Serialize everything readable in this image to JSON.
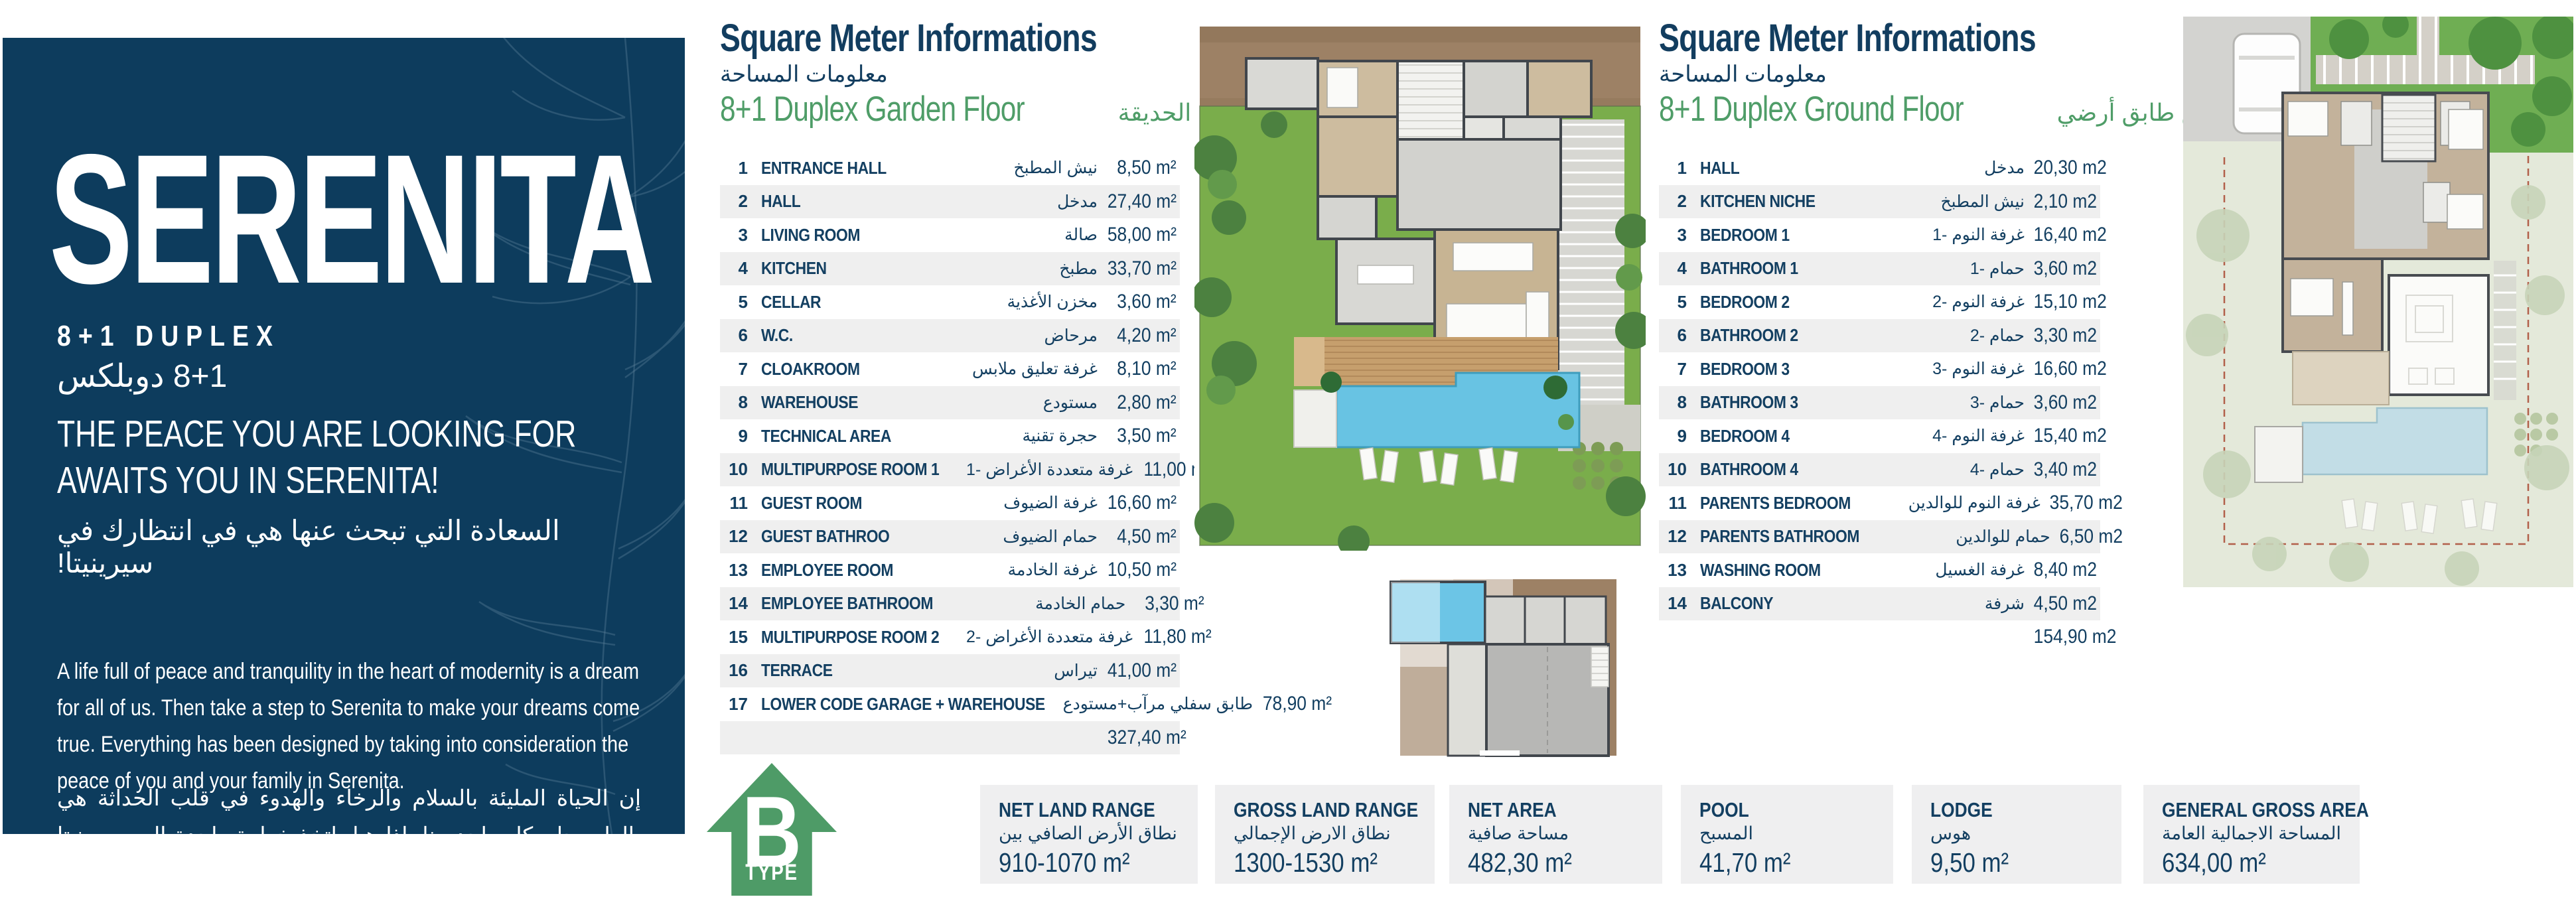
{
  "colors": {
    "panel_navy": "#0d3c5d",
    "text_navy": "#133f61",
    "accent_green": "#4e9b67",
    "row_stripe": "#efefef",
    "box_gray": "#efeff0",
    "lawn_green": "#7aad4b",
    "pool_blue": "#68c3e3",
    "ground_brown": "#9d8165",
    "pale_sage": "#e4e9da"
  },
  "left_panel": {
    "title": "SERENITA",
    "subtitle": "8+1 DUPLEX",
    "subtitle_ar": "8+1 دوبلكس",
    "headline1": "THE PEACE YOU ARE LOOKING FOR",
    "headline2": "AWAITS YOU IN SERENITA!",
    "headline_ar": "السعادة التي تبحث عنها هي في انتظارك في سيرينيتا!",
    "body": "A life full of peace and tranquility in the heart of modernity is a dream for all of us. Then take a step to Serenita to make your dreams come true. Everything has been designed by taking into consideration the peace of you and your family in Serenita.",
    "body_ar": "إن الحياة المليئة بالسلام والرخاء والهدوء في قلب الحداثة هي بالطبع حلم كل واحد منا. إذا هيا، اتخذ خطوة واحدة إلى سيرينيتا لتحقيق أحلامك حتى لا تفوت فرص الحياة. لقد تم تصميم كل شيء هنا لراحة البال لك وسلامة عائلتك."
  },
  "garden_table": {
    "header": "Square Meter Informations",
    "header_ar": "معلومات المساحة",
    "floor": "8+1 Duplex Garden Floor",
    "floor_ar": "8+1 دوبلكس مع الحديقة",
    "rows": [
      {
        "num": "1",
        "label": "ENTRANCE HALL",
        "ar": "نيش المطبخ",
        "value": "8,50 m²"
      },
      {
        "num": "2",
        "label": "HALL",
        "ar": "مدخل",
        "value": "27,40 m²"
      },
      {
        "num": "3",
        "label": "LIVING ROOM",
        "ar": "صالة",
        "value": "58,00 m²"
      },
      {
        "num": "4",
        "label": "KITCHEN",
        "ar": "مطبخ",
        "value": "33,70 m²"
      },
      {
        "num": "5",
        "label": "CELLAR",
        "ar": "مخزن الأغذية",
        "value": "3,60 m²"
      },
      {
        "num": "6",
        "label": "W.C.",
        "ar": "مرحاض",
        "value": "4,20 m²"
      },
      {
        "num": "7",
        "label": "CLOAKROOM",
        "ar": "غرفة تعليق ملابس",
        "value": "8,10 m²"
      },
      {
        "num": "8",
        "label": "WAREHOUSE",
        "ar": "مستودع",
        "value": "2,80 m²"
      },
      {
        "num": "9",
        "label": "TECHNICAL AREA",
        "ar": "حجرة تقنية",
        "value": "3,50 m²"
      },
      {
        "num": "10",
        "label": "MULTIPURPOSE ROOM 1",
        "ar": "غرفة متعددة الأغراض -1",
        "value": "11,00 m²"
      },
      {
        "num": "11",
        "label": "GUEST ROOM",
        "ar": "غرفة الضيوف",
        "value": "16,60 m²"
      },
      {
        "num": "12",
        "label": "GUEST BATHROO",
        "ar": "حمام الضيوف",
        "value": "4,50 m²"
      },
      {
        "num": "13",
        "label": "EMPLOYEE ROOM",
        "ar": "غرفة الخادمة",
        "value": "10,50 m²"
      },
      {
        "num": "14",
        "label": "EMPLOYEE BATHROOM",
        "ar": "حمام الخادمة",
        "value": "3,30 m²"
      },
      {
        "num": "15",
        "label": "MULTIPURPOSE ROOM 2",
        "ar": "غرفة متعددة الأغراض -2",
        "value": "11,80 m²"
      },
      {
        "num": "16",
        "label": "TERRACE",
        "ar": "تيراس",
        "value": "41,00 m²"
      },
      {
        "num": "17",
        "label": "LOWER CODE GARAGE + WAREHOUSE",
        "ar": "طابق سفلي مرآب+مستودع",
        "value": "78,90 m²"
      }
    ],
    "total": "327,40 m²"
  },
  "ground_table": {
    "header": "Square Meter Informations",
    "header_ar": "معلومات المساحة",
    "floor": "8+1 Duplex Ground Floor",
    "floor_ar": "8+1 دوبلكس طابق أرضي",
    "rows": [
      {
        "num": "1",
        "label": "HALL",
        "ar": "مدخل",
        "value": "20,30 m2"
      },
      {
        "num": "2",
        "label": "KITCHEN NICHE",
        "ar": "نيش المطبخ",
        "value": "2,10 m2"
      },
      {
        "num": "3",
        "label": "BEDROOM 1",
        "ar": "غرفة النوم -1",
        "value": "16,40 m2"
      },
      {
        "num": "4",
        "label": "BATHROOM 1",
        "ar": "حمام -1",
        "value": "3,60 m2"
      },
      {
        "num": "5",
        "label": "BEDROOM 2",
        "ar": "غرفة النوم -2",
        "value": "15,10 m2"
      },
      {
        "num": "6",
        "label": "BATHROOM 2",
        "ar": "حمام -2",
        "value": "3,30 m2"
      },
      {
        "num": "7",
        "label": "BEDROOM 3",
        "ar": "غرفة النوم -3",
        "value": "16,60 m2"
      },
      {
        "num": "8",
        "label": "BATHROOM 3",
        "ar": "حمام -3",
        "value": "3,60 m2"
      },
      {
        "num": "9",
        "label": "BEDROOM 4",
        "ar": "غرفة النوم -4",
        "value": "15,40 m2"
      },
      {
        "num": "10",
        "label": "BATHROOM 4",
        "ar": "حمام -4",
        "value": "3,40 m2"
      },
      {
        "num": "11",
        "label": "PARENTS BEDROOM",
        "ar": "غرفة النوم للوالدين",
        "value": "35,70 m2"
      },
      {
        "num": "12",
        "label": "PARENTS BATHROOM",
        "ar": "حمام للوالدين",
        "value": "6,50 m2"
      },
      {
        "num": "13",
        "label": "WASHING ROOM",
        "ar": "غرفة الغسيل",
        "value": "8,40 m2"
      },
      {
        "num": "14",
        "label": "BALCONY",
        "ar": "شرفة",
        "value": "4,50 m2"
      }
    ],
    "total": "154,90 m2"
  },
  "badge": {
    "letter": "B",
    "word": "TYPE"
  },
  "info_boxes": [
    {
      "title": "NET LAND RANGE",
      "ar": "نطاق الأرض الصافي بين",
      "value": "910-1070 m²"
    },
    {
      "title": "GROSS LAND RANGE",
      "ar": "نطاق الارض الإجمالي",
      "value": "1300-1530 m²"
    },
    {
      "title": "NET AREA",
      "ar": "مساحة صافية",
      "value": "482,30 m²"
    },
    {
      "title": "POOL",
      "ar": "المسبح",
      "value": "41,70 m²"
    },
    {
      "title": "LODGE",
      "ar": "هوس",
      "value": "9,50 m²"
    },
    {
      "title": "GENERAL GROSS AREA",
      "ar": "المساحة الاجمالية العامة",
      "value": "634,00 m²"
    }
  ]
}
